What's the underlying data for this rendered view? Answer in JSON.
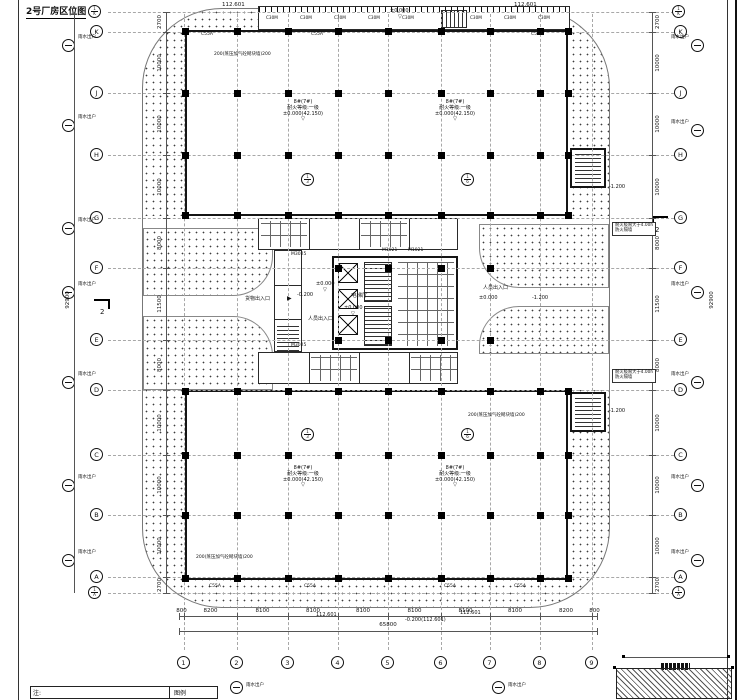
{
  "doc": {
    "title": "2号厂房区位图",
    "notes_label": "注:",
    "legend_label": "图例"
  },
  "colors": {
    "ink": "#111111",
    "grid": "#a8a8a8",
    "dim": "#555555",
    "bg": "#ffffff"
  },
  "grid": {
    "bottom_axes": [
      {
        "n": "1",
        "x": 184
      },
      {
        "n": "2",
        "x": 237
      },
      {
        "n": "3",
        "x": 288
      },
      {
        "n": "4",
        "x": 338
      },
      {
        "n": "5",
        "x": 388
      },
      {
        "n": "6",
        "x": 441
      },
      {
        "n": "7",
        "x": 490
      },
      {
        "n": "8",
        "x": 540
      },
      {
        "n": "9",
        "x": 592
      }
    ],
    "left_axes": [
      {
        "n": "K",
        "y": 32
      },
      {
        "n": "J",
        "y": 93
      },
      {
        "n": "H",
        "y": 155
      },
      {
        "n": "G",
        "y": 218
      },
      {
        "n": "F",
        "y": 268
      },
      {
        "n": "E",
        "y": 340
      },
      {
        "n": "D",
        "y": 390
      },
      {
        "n": "C",
        "y": 455
      },
      {
        "n": "B",
        "y": 515
      },
      {
        "n": "A",
        "y": 577
      }
    ],
    "sub_axes_h": [
      {
        "n": "1/K",
        "y": 12
      },
      {
        "n": "1/A",
        "y": 593
      }
    ],
    "sub_axes_v": [
      {
        "n": "1/3",
        "x": 308,
        "y": 173
      },
      {
        "n": "1/6",
        "x": 468,
        "y": 173
      },
      {
        "n": "1/3",
        "x": 308,
        "y": 428
      },
      {
        "n": "1/6",
        "x": 468,
        "y": 428
      }
    ],
    "rain": {
      "label": "雨水出户",
      "left_y": [
        45,
        125,
        228,
        292,
        382,
        485,
        560
      ],
      "right_y": [
        45,
        130,
        292,
        382,
        485,
        560
      ],
      "bottom": [
        {
          "x": 230,
          "y": 681
        },
        {
          "x": 492,
          "y": 681
        }
      ]
    }
  },
  "dims": {
    "bottom": {
      "ticks": [
        179,
        184,
        237,
        288,
        338,
        388,
        441,
        490,
        540,
        592,
        597
      ],
      "values": [
        "800",
        "8200",
        "8100",
        "8100",
        "8100",
        "8100",
        "8100",
        "8100",
        "8200",
        "800"
      ],
      "total": "65800"
    },
    "left": {
      "ticks": [
        12,
        32,
        93,
        155,
        218,
        268,
        340,
        390,
        455,
        515,
        577,
        593
      ],
      "values": [
        "2700",
        "10000",
        "10000",
        "10000",
        "8000",
        "11500",
        "8000",
        "10000",
        "10000",
        "10000",
        "2700"
      ],
      "total": "92900"
    }
  },
  "structure": {
    "xs": [
      185,
      237,
      288,
      338,
      388,
      441,
      490,
      540,
      568
    ],
    "top_rows": [
      31,
      93,
      155,
      215
    ],
    "bottom_rows": [
      391,
      455,
      515,
      578
    ],
    "mid_rows": [
      268,
      340
    ],
    "mid_xs": [
      338,
      388,
      441,
      490
    ]
  },
  "annotations": [
    {
      "t": "112.601",
      "x": 222,
      "y": 2,
      "f": 5.5
    },
    {
      "t": "112.601",
      "x": 514,
      "y": 2,
      "f": 5.5
    },
    {
      "t": "±0.000",
      "x": 390,
      "y": 9,
      "f": 5
    },
    {
      "t": "▽",
      "x": 398,
      "y": 15,
      "f": 5
    },
    {
      "t": "C30M",
      "x": 266,
      "y": 16,
      "f": 4.2
    },
    {
      "t": "C30M",
      "x": 300,
      "y": 16,
      "f": 4.2
    },
    {
      "t": "C30M",
      "x": 334,
      "y": 16,
      "f": 4.2
    },
    {
      "t": "C30M",
      "x": 368,
      "y": 16,
      "f": 4.2
    },
    {
      "t": "C30M",
      "x": 402,
      "y": 16,
      "f": 4.2
    },
    {
      "t": "C30M",
      "x": 470,
      "y": 16,
      "f": 4.2
    },
    {
      "t": "C30M",
      "x": 504,
      "y": 16,
      "f": 4.2
    },
    {
      "t": "C30M",
      "x": 538,
      "y": 16,
      "f": 4.2
    },
    {
      "t": "C55A",
      "x": 207,
      "y": 32,
      "f": 4.5,
      "a": "c"
    },
    {
      "t": "C55A",
      "x": 317,
      "y": 32,
      "f": 4.5,
      "a": "c"
    },
    {
      "t": "C55A",
      "x": 537,
      "y": 32,
      "f": 4.5,
      "a": "c"
    },
    {
      "t": "200(蒸压加气砼砌块墙)200",
      "x": 214,
      "y": 52,
      "f": 4.5
    },
    {
      "lines": [
        "8#(7#)",
        "耐火等级:一级",
        "±0.000(42.150)",
        "▽"
      ],
      "x": 303,
      "y": 100,
      "f": 5,
      "a": "c"
    },
    {
      "lines": [
        "8#(7#)",
        "耐火等级:一级",
        "±0.000(42.150)",
        "▽"
      ],
      "x": 455,
      "y": 100,
      "f": 5,
      "a": "c"
    },
    {
      "t": "M1021",
      "x": 382,
      "y": 248,
      "f": 4.5
    },
    {
      "t": "M1021",
      "x": 408,
      "y": 248,
      "f": 4.5
    },
    {
      "t": "M3025",
      "x": 291,
      "y": 252,
      "f": 4.5
    },
    {
      "t": "电梯厅",
      "x": 351,
      "y": 293,
      "f": 5.5
    },
    {
      "t": "±0.000",
      "x": 316,
      "y": 282,
      "f": 5
    },
    {
      "t": "▽",
      "x": 323,
      "y": 288,
      "f": 5
    },
    {
      "t": "±0.000",
      "x": 344,
      "y": 306,
      "f": 5
    },
    {
      "t": "▽",
      "x": 351,
      "y": 312,
      "f": 5
    },
    {
      "t": "人员出入口",
      "x": 308,
      "y": 317,
      "f": 5
    },
    {
      "t": "人员出入口",
      "x": 483,
      "y": 286,
      "f": 5
    },
    {
      "t": "±0.000",
      "x": 479,
      "y": 296,
      "f": 5
    },
    {
      "t": "-1.200",
      "x": 532,
      "y": 296,
      "f": 5
    },
    {
      "t": "货物出入口",
      "x": 245,
      "y": 297,
      "f": 5
    },
    {
      "t": "▶",
      "x": 287,
      "y": 296,
      "f": 6
    },
    {
      "t": "-0.200",
      "x": 297,
      "y": 293,
      "f": 5
    },
    {
      "t": "-1.200",
      "x": 609,
      "y": 185,
      "f": 5
    },
    {
      "t": "-1.200",
      "x": 609,
      "y": 409,
      "f": 5
    },
    {
      "t": "M3025",
      "x": 291,
      "y": 343,
      "f": 4.5
    },
    {
      "t": "200(蒸压加气砼砌块墙)200",
      "x": 468,
      "y": 413,
      "f": 4.5
    },
    {
      "lines": [
        "8#(7#)",
        "耐火等级:一级",
        "±0.000(42.150)",
        "▽"
      ],
      "x": 303,
      "y": 466,
      "f": 5,
      "a": "c"
    },
    {
      "lines": [
        "8#(7#)",
        "耐火等级:一级",
        "±0.000(42.150)",
        "▽"
      ],
      "x": 455,
      "y": 466,
      "f": 5,
      "a": "c"
    },
    {
      "t": "200(蒸压加气砼砌块墙)200",
      "x": 196,
      "y": 555,
      "f": 4.5
    },
    {
      "t": "C55A",
      "x": 215,
      "y": 584,
      "f": 4.5,
      "a": "c"
    },
    {
      "t": "C55A",
      "x": 310,
      "y": 584,
      "f": 4.5,
      "a": "c"
    },
    {
      "t": "C55A",
      "x": 450,
      "y": 584,
      "f": 4.5,
      "a": "c"
    },
    {
      "t": "C55A",
      "x": 520,
      "y": 584,
      "f": 4.5,
      "a": "c"
    },
    {
      "t": "112.601",
      "x": 316,
      "y": 613,
      "f": 5
    },
    {
      "t": "-0.200(112.601)",
      "x": 405,
      "y": 618,
      "f": 5
    },
    {
      "t": "112.601",
      "x": 460,
      "y": 611,
      "f": 5
    },
    {
      "lines": [
        "耐火极限大于4.00h",
        "防火隔墙"
      ],
      "x": 612,
      "y": 222,
      "f": 4.3,
      "cls": "note-box"
    },
    {
      "lines": [
        "耐火极限大于4.00h",
        "防火隔墙"
      ],
      "x": 612,
      "y": 369,
      "f": 4.3,
      "cls": "note-box"
    },
    {
      "t": "2",
      "x": 100,
      "y": 308,
      "f": 7
    },
    {
      "t": "2",
      "x": 655,
      "y": 226,
      "f": 7
    }
  ]
}
